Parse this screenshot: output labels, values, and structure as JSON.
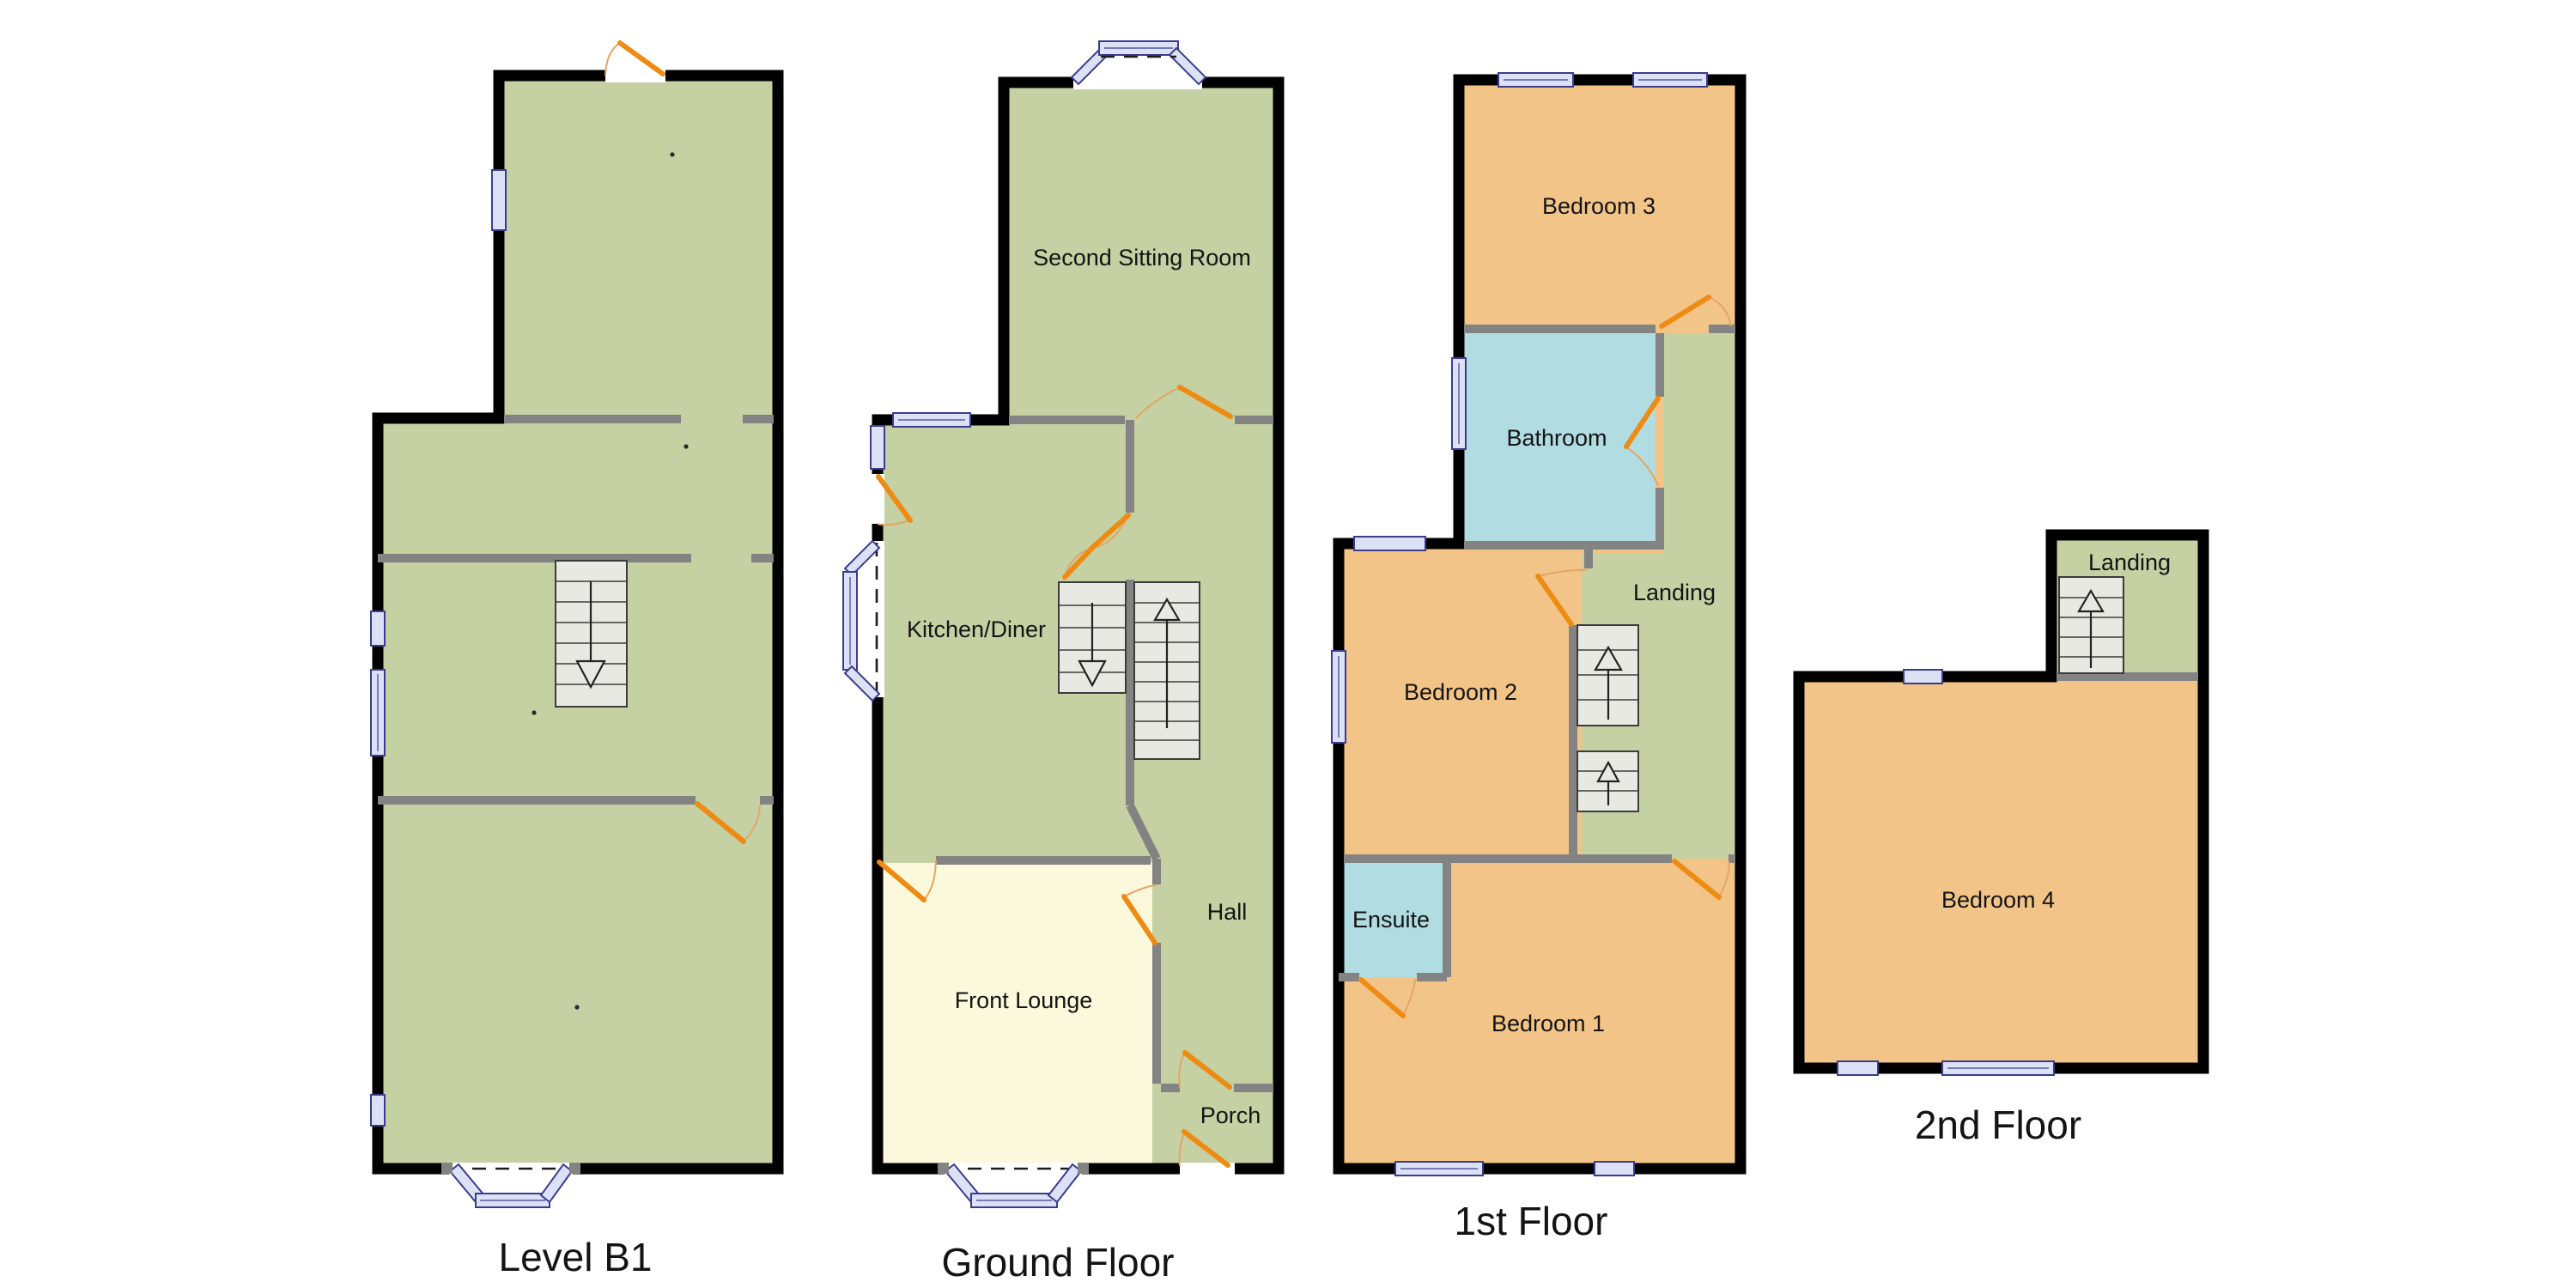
{
  "document": {
    "type": "floorplan",
    "background": "#ffffff"
  },
  "colors": {
    "green": "#c5d0a3",
    "orange": "#f2c488",
    "blue": "#b0dce2",
    "cream": "#fbf8dc",
    "winfill": "#dde1f6",
    "winborder": "#3c3c8e",
    "door": "#ee8b12",
    "arc": "#e3a566",
    "wall": "#000000",
    "gray": "#838383",
    "stairfill": "#e9e9e3",
    "stairline": "#3c3c3c",
    "text": "#141414"
  },
  "floors": {
    "level_b1": {
      "title": "Level B1",
      "rooms": {}
    },
    "ground": {
      "title": "Ground Floor",
      "rooms": {
        "second_sitting_room": "Second Sitting Room",
        "kitchen_diner": "Kitchen/Diner",
        "front_lounge": "Front Lounge",
        "hall": "Hall",
        "porch": "Porch"
      }
    },
    "first": {
      "title": "1st Floor",
      "rooms": {
        "bedroom3": "Bedroom 3",
        "bathroom": "Bathroom",
        "landing": "Landing",
        "bedroom2": "Bedroom 2",
        "ensuite": "Ensuite",
        "bedroom1": "Bedroom 1"
      }
    },
    "second": {
      "title": "2nd Floor",
      "rooms": {
        "landing": "Landing",
        "bedroom4": "Bedroom 4"
      }
    }
  }
}
